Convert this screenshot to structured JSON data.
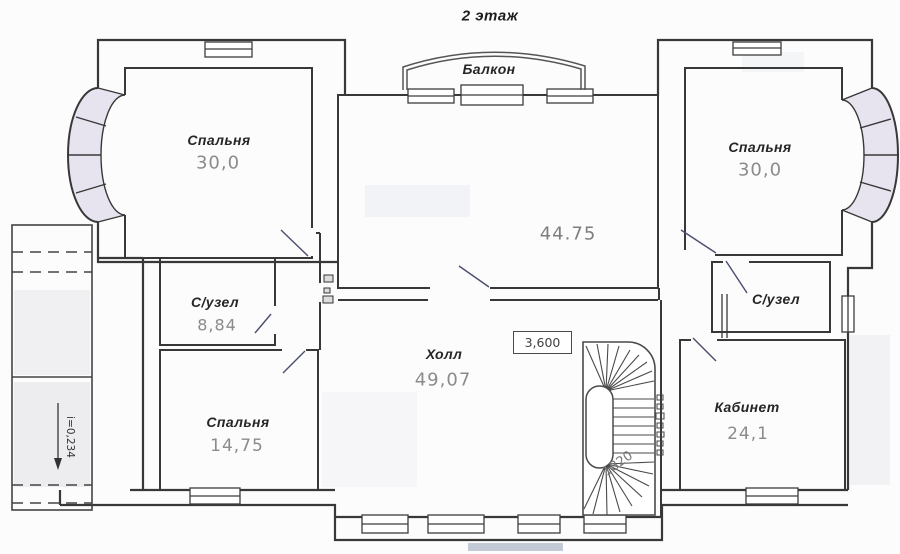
{
  "title": "2 этаж",
  "rooms": [
    {
      "name": "balcony",
      "label": "Балкон",
      "area": ""
    },
    {
      "name": "bedroom-left",
      "label": "Спальня",
      "area": "30,0"
    },
    {
      "name": "living-room",
      "label": "",
      "area": "44.75"
    },
    {
      "name": "bedroom-right",
      "label": "Спальня",
      "area": "30,0"
    },
    {
      "name": "bathroom-left",
      "label": "С/узел",
      "area": "8,84"
    },
    {
      "name": "bathroom-right",
      "label": "С/узел",
      "area": ""
    },
    {
      "name": "bedroom-small",
      "label": "Спальня",
      "area": "14,75"
    },
    {
      "name": "hall",
      "label": "Холл",
      "area": "49,07"
    },
    {
      "name": "study",
      "label": "Кабинет",
      "area": "24,1"
    }
  ],
  "annotations": {
    "elevation_mark": "3,600",
    "slope": "i=0,234",
    "stair_width": "1820"
  },
  "colors": {
    "wall": "#383838",
    "label_text": "#262626",
    "area_text": "#8b8b8b",
    "door": "#4a4e6e",
    "bay_tint": "#e7e4ef"
  }
}
